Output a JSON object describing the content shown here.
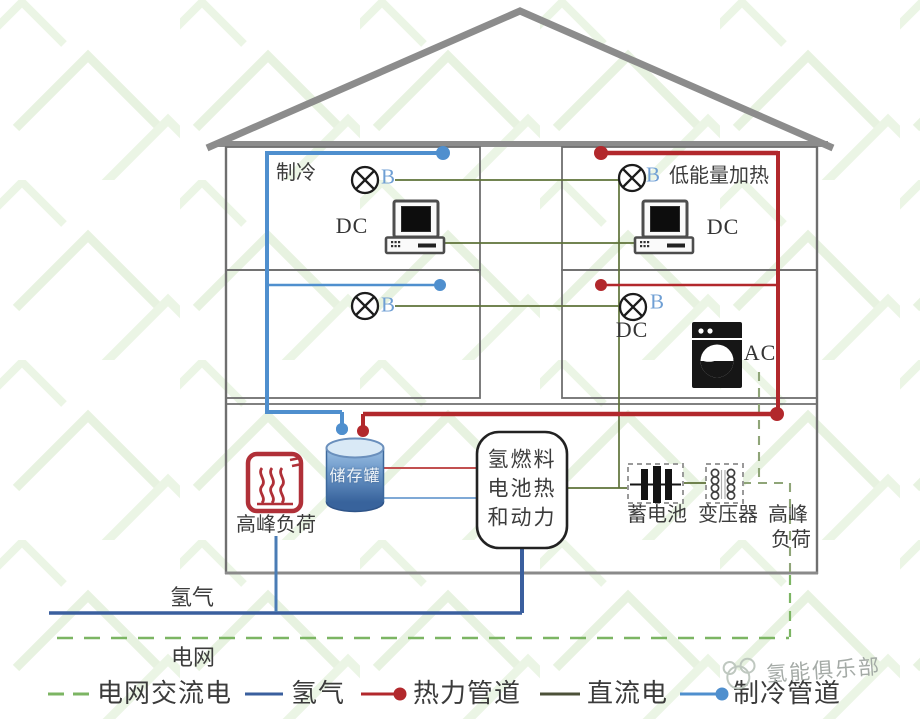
{
  "labels": {
    "cooling_room": "制冷",
    "heating_room": "低能量加热",
    "lamp": "B",
    "dc": "DC",
    "ac": "AC"
  },
  "equipment": {
    "storage_tank": "储存罐",
    "fuel_cell": [
      "氢燃料",
      "电池热",
      "和动力"
    ],
    "battery": "蓄电池",
    "transformer": "变压器",
    "peak_load": "高峰负荷",
    "peak_load_right": [
      "高峰",
      "负荷"
    ]
  },
  "pipes": {
    "hydrogen": "氢气",
    "grid": "电网"
  },
  "legend": {
    "items": [
      {
        "label": "电网交流电",
        "style": "dashed",
        "color": "#7cb563"
      },
      {
        "label": "氢气",
        "style": "solid",
        "color": "#3a5f9e"
      },
      {
        "label": "热力管道",
        "style": "solid-dot",
        "color": "#b2282c"
      },
      {
        "label": "直流电",
        "style": "solid",
        "color": "#4c5138"
      },
      {
        "label": "制冷管道",
        "style": "solid-dot",
        "color": "#4f8fce"
      }
    ]
  },
  "watermark": {
    "text": "氢能俱乐部"
  },
  "colors": {
    "cooling": "#4f8fce",
    "cooling_thin": "#7fa9d6",
    "heating": "#b2282c",
    "heating_thin": "#c25050",
    "hydrogen": "#3a5f9e",
    "hydrogen_branch": "#4a7cb5",
    "dc_line": "#5e7238",
    "grid_ac": "#7cb563",
    "ac_branch": "#8fa578",
    "wall": "#6f6f6f",
    "roof": "#8c8c8c"
  }
}
